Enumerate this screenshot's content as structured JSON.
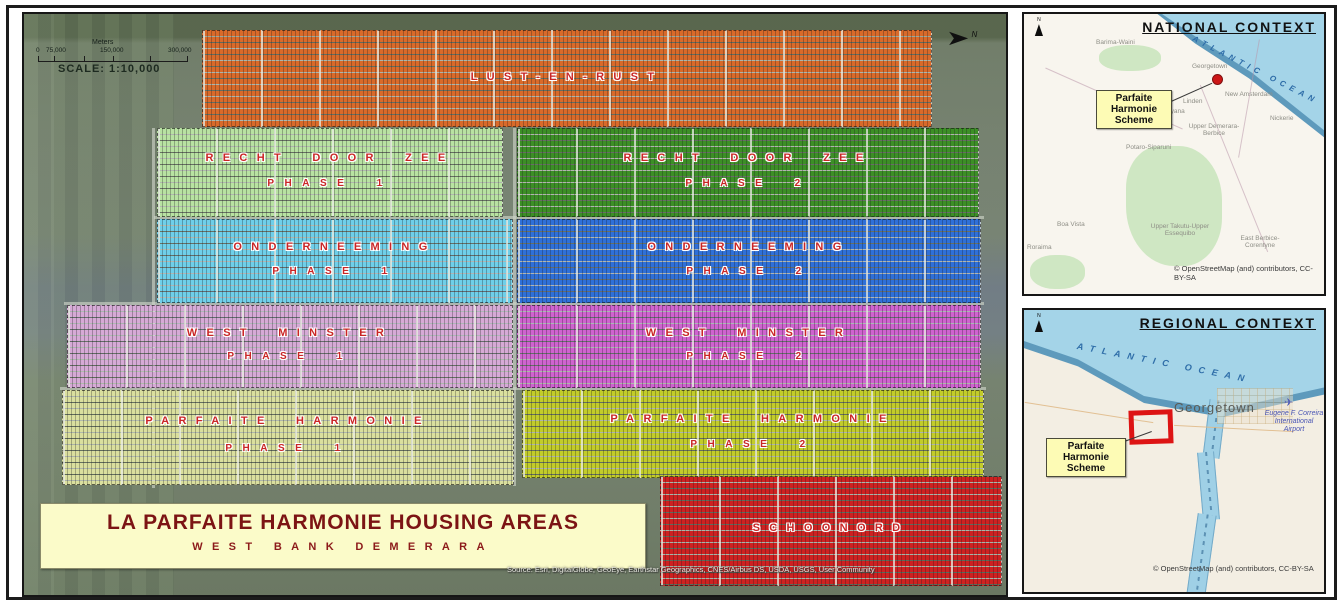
{
  "main_map": {
    "scale": {
      "units": "Meters",
      "ticks": [
        "0",
        "75,000",
        "150,000",
        "300,000"
      ],
      "text": "SCALE: 1:10,000"
    },
    "north_label": "N",
    "north_arrow": "➤",
    "label_color": "#c92525",
    "regions": [
      {
        "name": "LUST-EN-RUST",
        "phase": "",
        "color": "#d96a2a"
      },
      {
        "name": "RECHT DOOR ZEE",
        "phase": "PHASE 1",
        "color": "#b8e2a2"
      },
      {
        "name": "RECHT DOOR ZEE",
        "phase": "PHASE 2",
        "color": "#3c8f26"
      },
      {
        "name": "ONDERNEEMING",
        "phase": "PHASE 1",
        "color": "#6fcfe9"
      },
      {
        "name": "ONDERNEEMING",
        "phase": "PHASE 2",
        "color": "#2f70d8"
      },
      {
        "name": "WEST MINSTER",
        "phase": "PHASE 1",
        "color": "#d6aad6"
      },
      {
        "name": "WEST MINSTER",
        "phase": "PHASE 2",
        "color": "#cf63cf"
      },
      {
        "name": "PARFAITE HARMONIE",
        "phase": "PHASE 1",
        "color": "#dadf9e"
      },
      {
        "name": "PARFAITE HARMONIE",
        "phase": "PHASE 2",
        "color": "#c2cc2a"
      },
      {
        "name": "SCHOONORD",
        "phase": "",
        "color": "#ce2121"
      }
    ],
    "title_box": {
      "title": "LA PARFAITE HARMONIE HOUSING AREAS",
      "subtitle": "WEST BANK DEMERARA",
      "bg": "#fbfbc9",
      "text_color": "#7c1414"
    },
    "attribution": "Source: Esri, DigitalGlobe, GeoEye, Earthstar Geographics, CNES/Airbus DS, USDA, USGS, User Community"
  },
  "national_inset": {
    "title": "NATIONAL CONTEXT",
    "north_label": "N",
    "ocean_label": "ATLANTIC OCEAN",
    "callout": "Parfaite Harmonie Scheme",
    "labels": {
      "barima": "Barima-Waini",
      "georgetown": "Georgetown",
      "linden": "Linden",
      "new_amsterdam": "New Amsterdam",
      "guyana": "Guyana",
      "upper_demerara": "Upper Demerara-Berbice",
      "potaro": "Potaro-Siparuni",
      "nickerie": "Nickerie",
      "boa_vista": "Boa Vista",
      "upper_takutu": "Upper Takutu-Upper Essequibo",
      "east_berbice": "East Berbice-Corentyne",
      "roraima": "Roraima"
    },
    "attribution": "© OpenStreetMap (and) contributors, CC-BY-SA"
  },
  "regional_inset": {
    "title": "REGIONAL CONTEXT",
    "north_label": "N",
    "ocean_label": "ATLANTIC OCEAN",
    "city": "Georgetown",
    "airport": "Eugene F. Correira International Airport",
    "plane_icon": "✈",
    "callout": "Parfaite Harmonie Scheme",
    "attribution": "© OpenStreetMap (and) contributors, CC-BY-SA"
  }
}
